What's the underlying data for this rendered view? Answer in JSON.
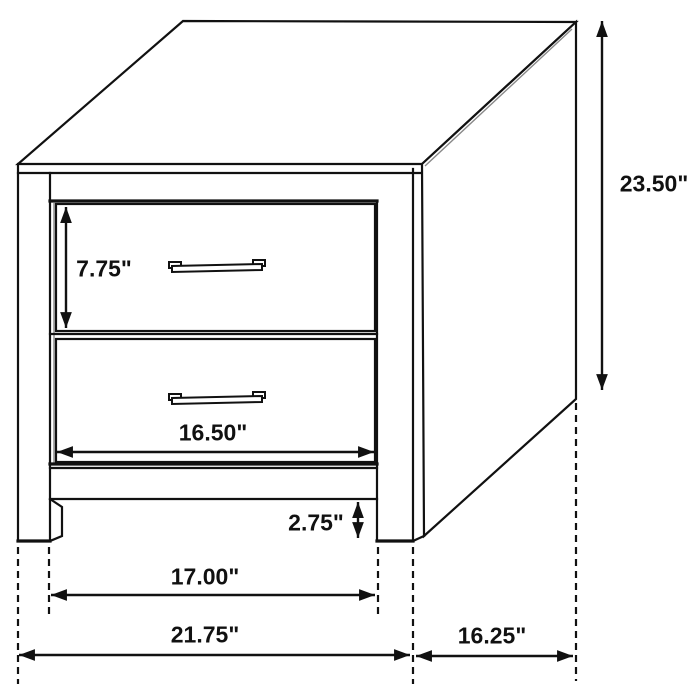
{
  "figure": {
    "type": "furniture-dimension-diagram",
    "subject": "two-drawer nightstand line drawing",
    "units": "inches",
    "background_color": "#ffffff",
    "line_color": "#111111"
  },
  "labels": {
    "overall_height": "23.50\"",
    "drawer_height": "7.75\"",
    "drawer_width": "16.50\"",
    "base_clearance": "2.75\"",
    "inner_leg_span": "17.00\"",
    "overall_width": "21.75\"",
    "side_depth": "16.25\""
  }
}
